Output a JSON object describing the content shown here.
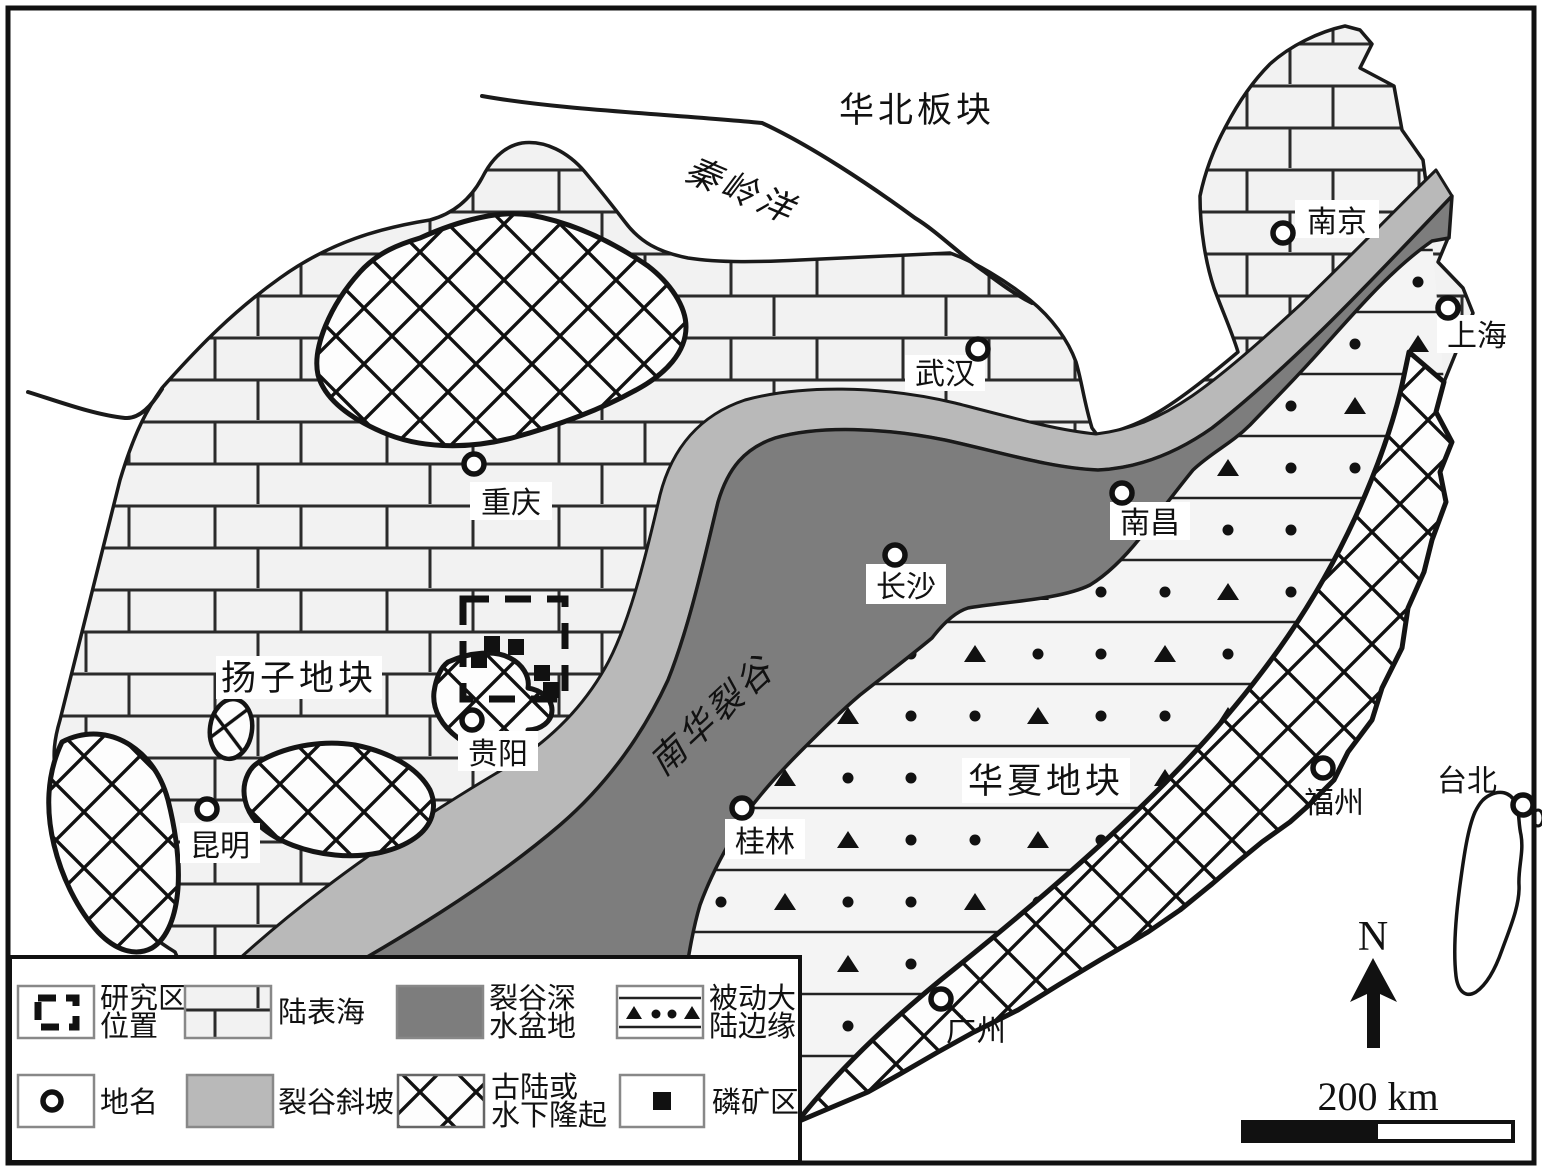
{
  "figure": {
    "type": "paleogeographic-tectonic-map",
    "regions": {
      "north_china_plate": "华北板块",
      "qinling_ocean": "秦岭洋",
      "yangtze_block": "扬子地块",
      "nanhua_rift": "南华裂谷",
      "cathaysia_block": "华夏地块"
    },
    "cities": {
      "nanjing": "南京",
      "shanghai": "上海",
      "wuhan": "武汉",
      "chongqing": "重庆",
      "nanchang": "南昌",
      "changsha": "长沙",
      "guiyang": "贵阳",
      "kunming": "昆明",
      "guilin": "桂林",
      "fuzhou": "福州",
      "guangzhou": "广州",
      "taipei": "台北"
    },
    "legend": {
      "items": [
        {
          "symbol": "study-area-box",
          "lines": [
            "研究区",
            "位置"
          ]
        },
        {
          "symbol": "epicontinental-sea",
          "lines": [
            "陆表海",
            ""
          ]
        },
        {
          "symbol": "rift-deep-basin",
          "lines": [
            "裂谷深",
            "水盆地"
          ]
        },
        {
          "symbol": "passive-margin",
          "lines": [
            "被动大",
            "陆边缘"
          ]
        },
        {
          "symbol": "place-name",
          "lines": [
            "地名",
            ""
          ]
        },
        {
          "symbol": "rift-slope",
          "lines": [
            "裂谷斜坡",
            ""
          ]
        },
        {
          "symbol": "paleoland-uplift",
          "lines": [
            "古陆或",
            "水下隆起"
          ]
        },
        {
          "symbol": "phosphate-area",
          "lines": [
            "磷矿区",
            ""
          ]
        }
      ]
    },
    "compass": {
      "north": "N"
    },
    "scale_bar": {
      "label": "200 km"
    },
    "colors": {
      "deep_basin": "#7d7d7d",
      "rift_slope": "#b9b9b9",
      "sea_brick_fill": "#f2f2f2",
      "passive_margin_bg": "#f4f4f4",
      "line": "#1a1a1a",
      "ocean": "#ffffff"
    }
  }
}
